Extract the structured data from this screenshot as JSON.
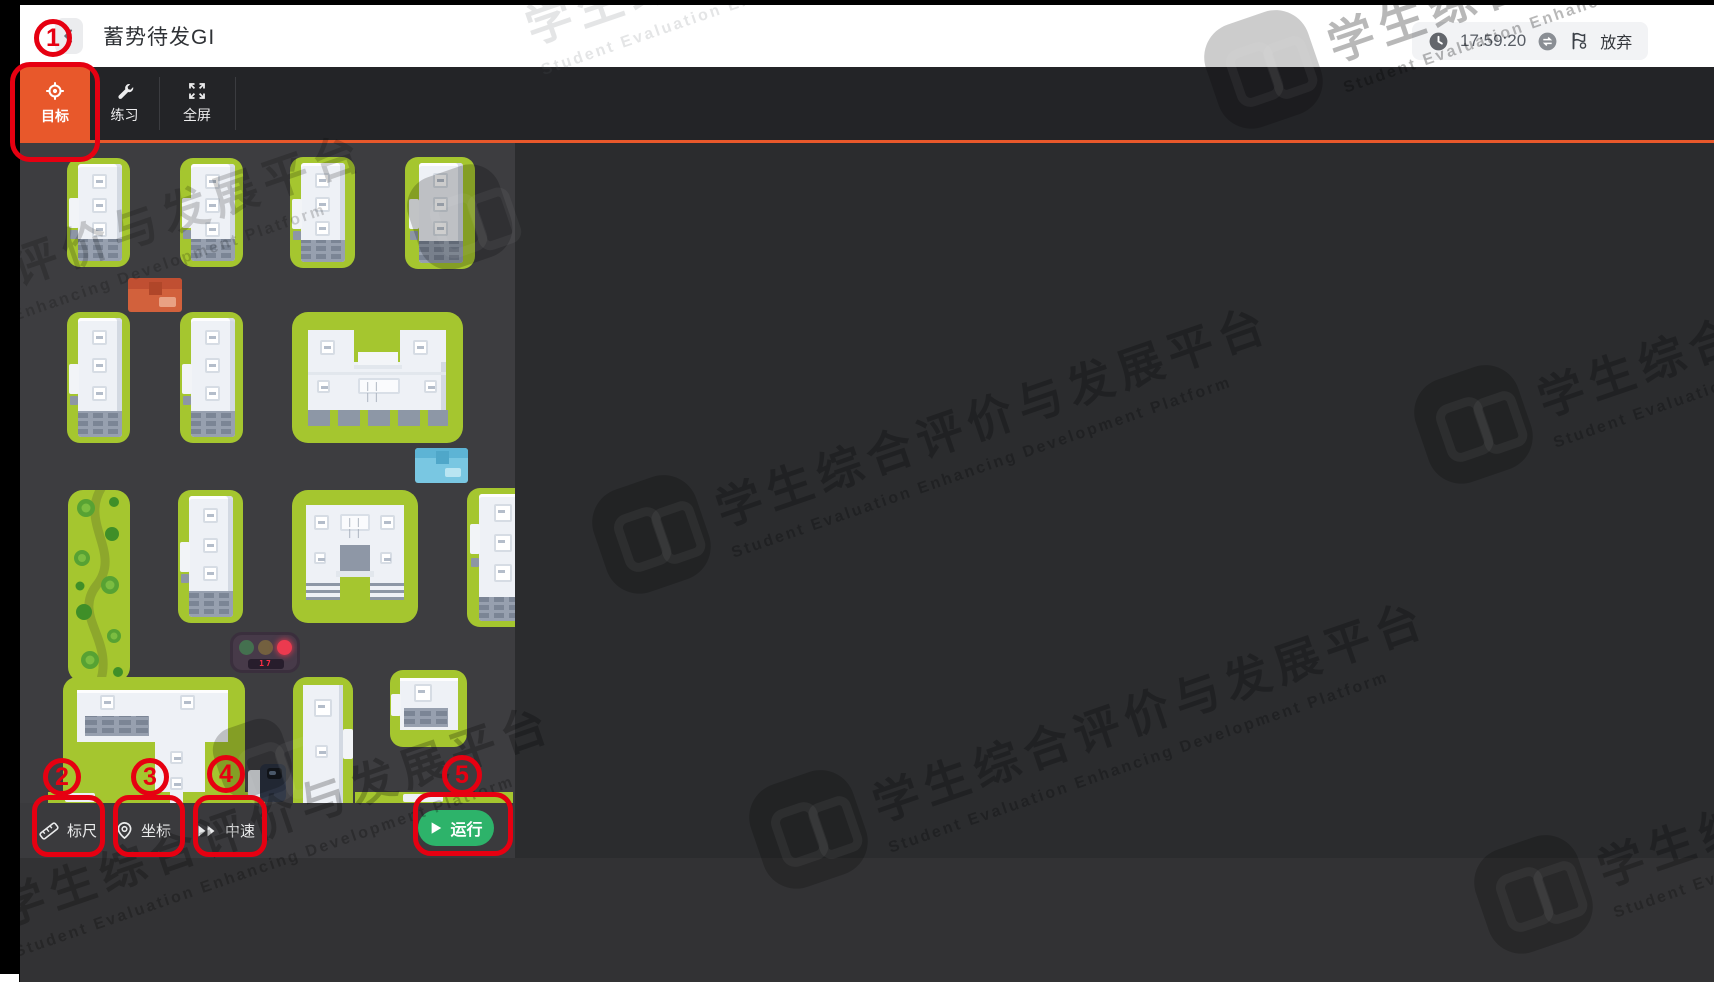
{
  "header": {
    "title": "蓄势待发GI"
  },
  "statusbar": {
    "time": "17:59:20",
    "abandon_label": "放弃"
  },
  "tabs": [
    {
      "label": "目标",
      "active": true
    },
    {
      "label": "练习",
      "active": false
    },
    {
      "label": "全屏",
      "active": false
    }
  ],
  "map": {
    "traffic_light_countdown": "17"
  },
  "controls": {
    "ruler_label": "标尺",
    "coordinate_label": "坐标",
    "speed_label": "中速",
    "run_label": "运行"
  },
  "watermark": {
    "cn": "学生综合评价与发展平台",
    "en": "Student Evaluation Enhancing Development Platform"
  },
  "annotations": [
    {
      "label": "1"
    },
    {
      "label": "2"
    },
    {
      "label": "3"
    },
    {
      "label": "4"
    },
    {
      "label": "5"
    }
  ],
  "colors": {
    "accent_orange": "#e8582b",
    "run_green": "#2db36a",
    "annotation_red": "#e60011",
    "lawn_green": "#a5c62f"
  }
}
